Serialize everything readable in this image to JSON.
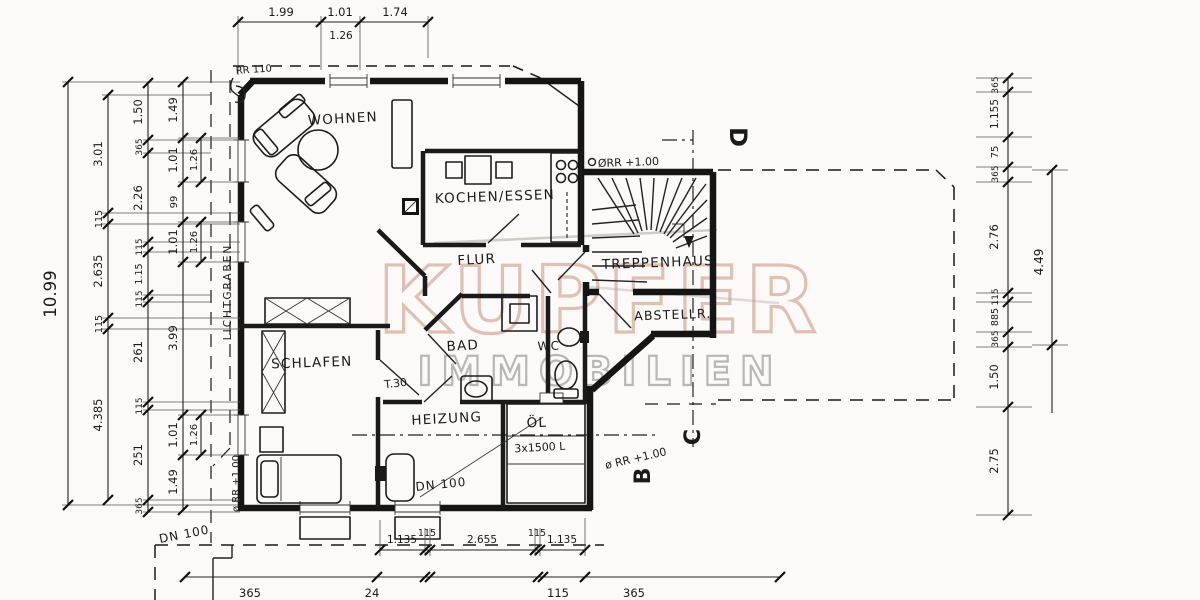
{
  "watermark": {
    "line1": "KUPFER",
    "line2": "IMMOBILIEN",
    "copper": "#dcb6a6",
    "gray": "#b3b0ac"
  },
  "colors": {
    "paper": "#fbfaf8",
    "ink": "#1a1a1a"
  },
  "rooms": {
    "wohnen": "WOHNEN",
    "kochen": "KOCHEN/ESSEN",
    "flur": "FLUR",
    "treppenhaus": "TREPPENHAUS",
    "abstellr": "ABSTELLR.",
    "schlafen": "SCHLAFEN",
    "bad": "BAD",
    "wc": "WC",
    "heizung": "HEIZUNG",
    "oel": "ÖL"
  },
  "ann": {
    "rr_top_left": "RR 110",
    "rr_stair": "ØRR +1.00",
    "rr_right": "ø RR +1.00",
    "rr_left": "ø RR +1.00",
    "dn_left": "DN 100",
    "dn_heizung": "DN 100",
    "t30": "T.30",
    "tanks": "3x1500 L",
    "lichtgraben": "LICHTGRABEN"
  },
  "sections": {
    "d": "D",
    "c": "C",
    "b": "B"
  },
  "dims": {
    "top": [
      "1.99",
      "1.01",
      "1.74"
    ],
    "top_sub": "1.26",
    "left_total": "10.99",
    "left_b": [
      "3.01",
      "115",
      "2.635",
      "115",
      "4.385"
    ],
    "left_c": [
      "1.50",
      "365",
      "2.26",
      "115",
      "1.15",
      "115",
      "261",
      "115",
      "251",
      "365"
    ],
    "left_d": [
      "1.49",
      "1.01",
      "99",
      "1.01",
      "3.99",
      "1.01",
      "1.49"
    ],
    "left_windows": [
      "1.26",
      "1.26",
      "1.26"
    ],
    "right": [
      "365",
      "1.155",
      "75",
      "365",
      "2.76",
      "115",
      "885",
      "365",
      "1.50",
      "2.75"
    ],
    "right_total": "4.49",
    "bottom": [
      "1.135",
      "115",
      "2.655",
      "115",
      "1.135"
    ],
    "bottom_edge": [
      "365",
      "24",
      "115",
      "365"
    ]
  }
}
